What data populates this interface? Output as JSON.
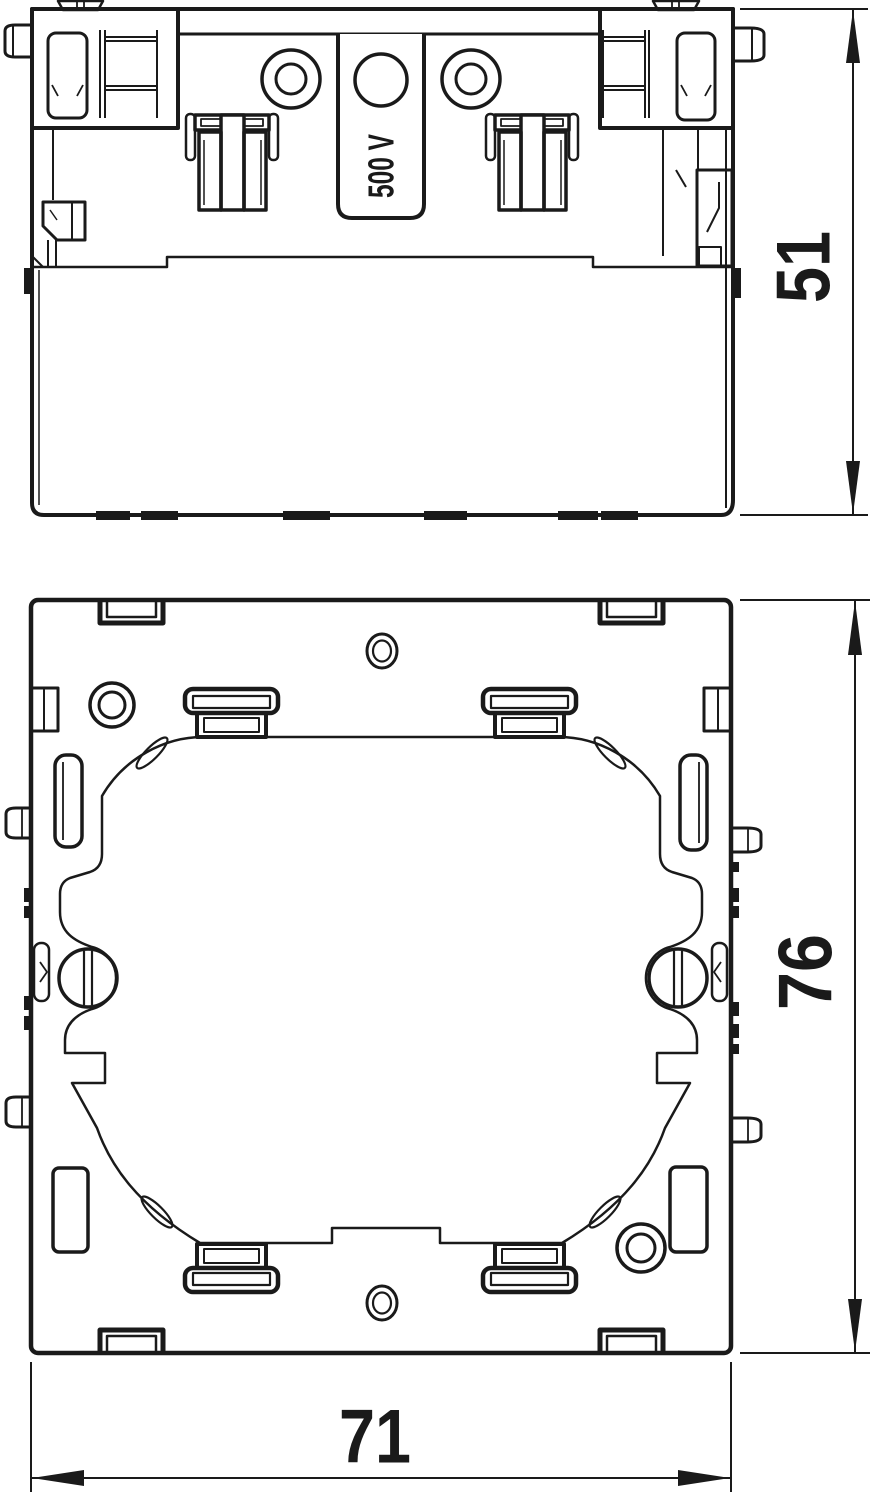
{
  "page": {
    "title": "Mounting frame technical drawing",
    "background": "#ffffff",
    "line_color": "#1a1a1a"
  },
  "drawing": {
    "type": "technical-orthographic-drawing",
    "units_implied": "mm",
    "side_view": {
      "name": "side elevation",
      "marking_label": "500 V",
      "height_dimension": "51"
    },
    "front_view": {
      "name": "front view",
      "height_dimension": "76",
      "width_dimension": "71"
    }
  }
}
